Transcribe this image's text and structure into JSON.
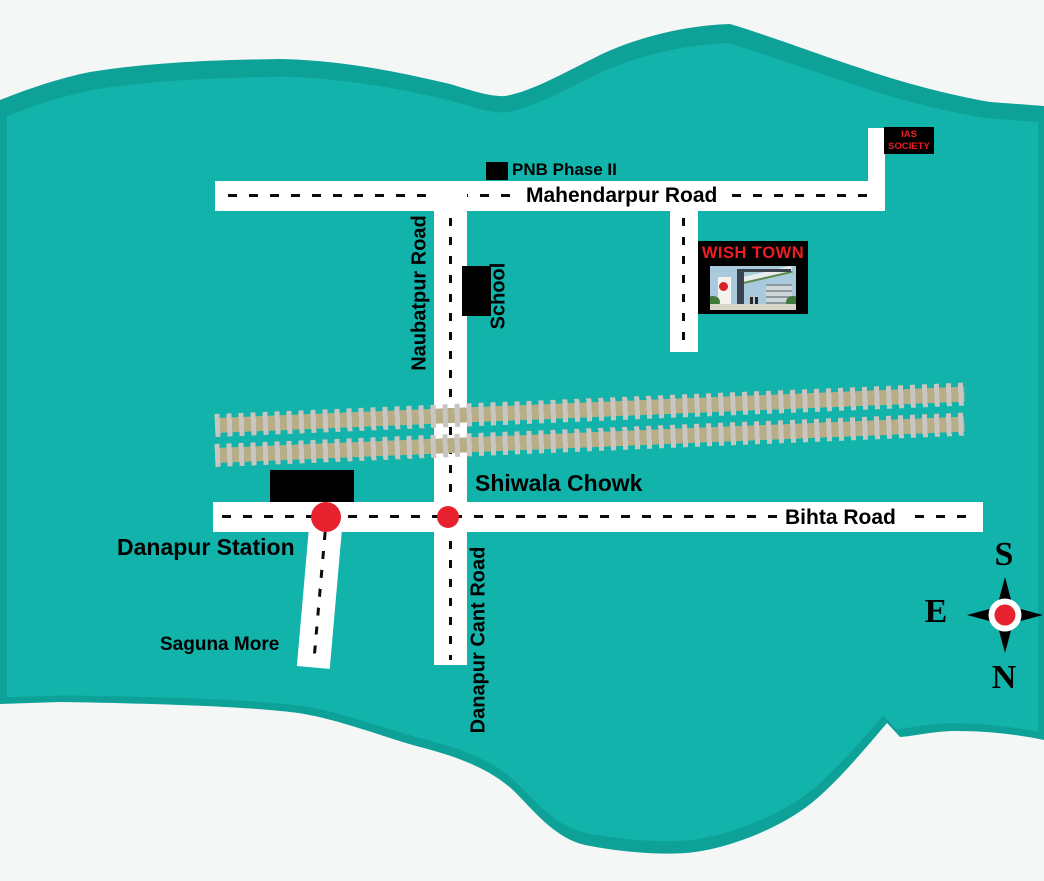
{
  "roads": {
    "mahendarpur": {
      "label": "Mahendarpur Road"
    },
    "naubatpur": {
      "label": "Naubatpur Road"
    },
    "danapur_cant": {
      "label": "Danapur Cant Road"
    },
    "bihta": {
      "label": "Bihta Road"
    }
  },
  "places": {
    "pnb": {
      "label": "PNB Phase II"
    },
    "school": {
      "label": "School"
    },
    "shiwala_chowk": {
      "label": "Shiwala Chowk"
    },
    "danapur_station": {
      "label": "Danapur Station"
    },
    "saguna_more": {
      "label": "Saguna More"
    },
    "ias_society": {
      "line1": "IAS",
      "line2": "SOCIETY"
    },
    "wish_town": {
      "label": "WISH TOWN"
    }
  },
  "compass": {
    "top": "S",
    "left": "E",
    "bottom": "N"
  },
  "colors": {
    "land": "#12b3ab",
    "land_dark": "#0da198",
    "background": "#f5f6f6",
    "road": "#ffffff",
    "railway_bed": "#b7ae87",
    "railway_tie": "#c9c6c1",
    "marker_red": "#e8212e",
    "sign_red": "#ee1c24",
    "black": "#000000"
  }
}
